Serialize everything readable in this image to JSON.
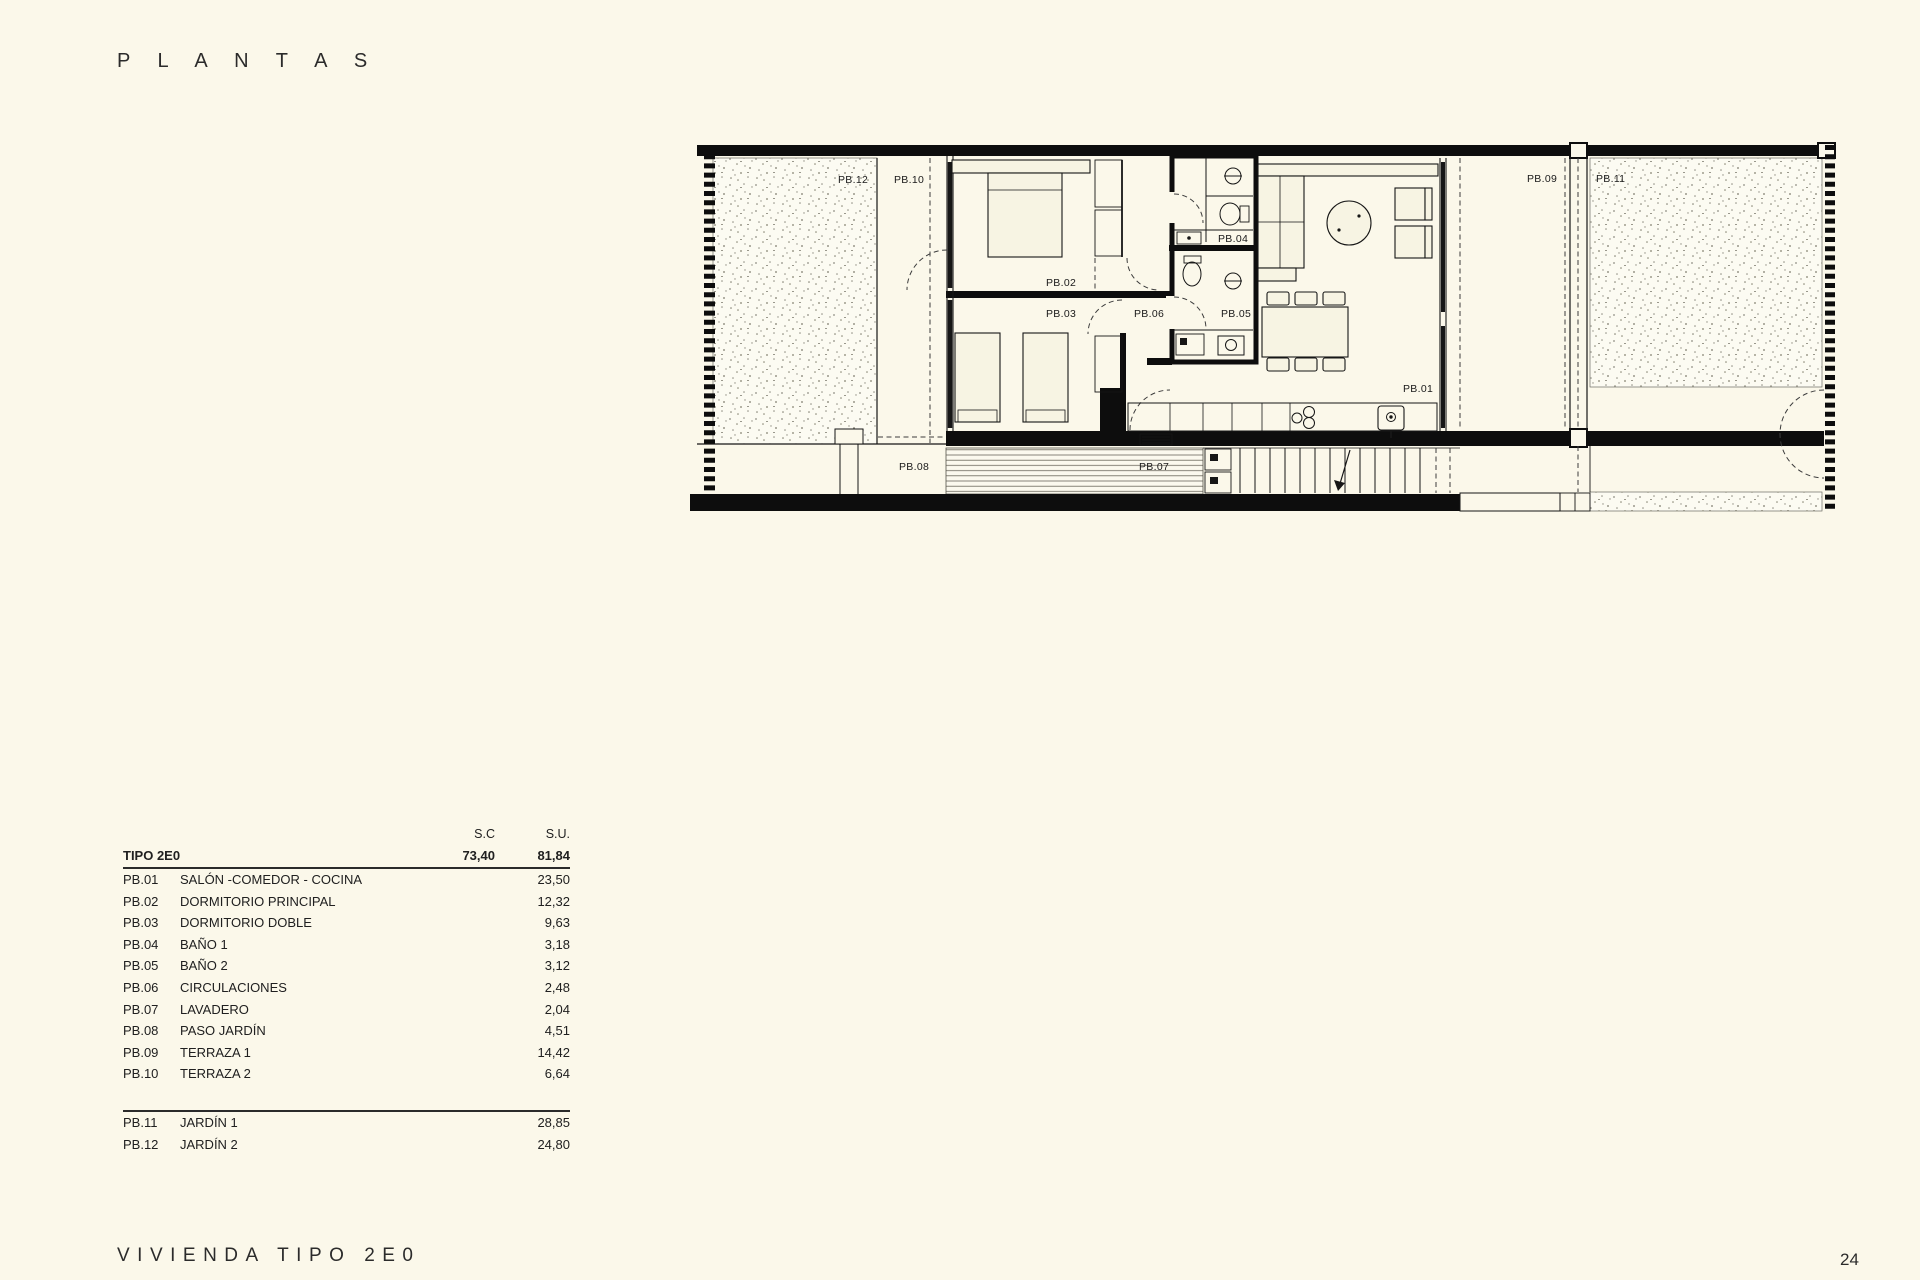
{
  "page": {
    "title": "P L A N T A S",
    "footer": "VIVIENDA TIPO 2E0",
    "page_number": "24"
  },
  "table": {
    "col_sc": "S.C",
    "col_su": "S.U.",
    "type_row": {
      "label": "TIPO 2E0",
      "sc": "73,40",
      "su": "81,84"
    },
    "rows": [
      {
        "code": "PB.01",
        "name": "SALÓN -COMEDOR - COCINA",
        "su": "23,50"
      },
      {
        "code": "PB.02",
        "name": "DORMITORIO PRINCIPAL",
        "su": "12,32"
      },
      {
        "code": "PB.03",
        "name": "DORMITORIO DOBLE",
        "su": "9,63"
      },
      {
        "code": "PB.04",
        "name": "BAÑO 1",
        "su": "3,18"
      },
      {
        "code": "PB.05",
        "name": "BAÑO 2",
        "su": "3,12"
      },
      {
        "code": "PB.06",
        "name": "CIRCULACIONES",
        "su": "2,48"
      },
      {
        "code": "PB.07",
        "name": "LAVADERO",
        "su": "2,04"
      },
      {
        "code": "PB.08",
        "name": "PASO JARDÍN",
        "su": "4,51"
      },
      {
        "code": "PB.09",
        "name": "TERRAZA 1",
        "su": "14,42"
      },
      {
        "code": "PB.10",
        "name": "TERRAZA 2",
        "su": "6,64"
      }
    ],
    "outdoor_rows": [
      {
        "code": "PB.11",
        "name": "JARDÍN 1",
        "su": "28,85"
      },
      {
        "code": "PB.12",
        "name": "JARDÍN 2",
        "su": "24,80"
      }
    ]
  },
  "plan": {
    "labels": {
      "pb01": "PB.01",
      "pb02": "PB.02",
      "pb03": "PB.03",
      "pb04": "PB.04",
      "pb05": "PB.05",
      "pb06": "PB.06",
      "pb07": "PB.07",
      "pb08": "PB.08",
      "pb09": "PB.09",
      "pb10": "PB.10",
      "pb11": "PB.11",
      "pb12": "PB.12"
    }
  },
  "colors": {
    "background": "#FBF8EA",
    "ink": "#0d0d0d"
  }
}
